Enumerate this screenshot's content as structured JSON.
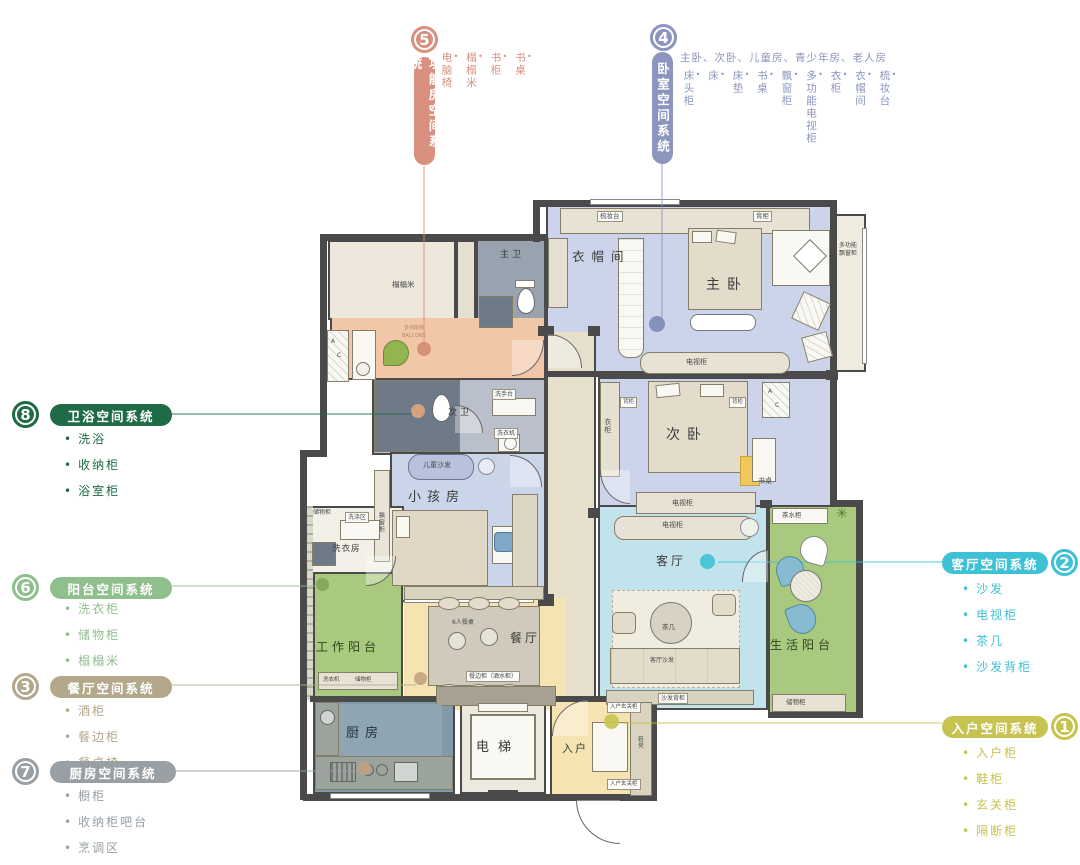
{
  "systems": {
    "s1": {
      "num": "1",
      "name": "入户空间系统",
      "color": "#C6C350",
      "items": [
        "入户柜",
        "鞋柜",
        "玄关柜",
        "隔断柜"
      ]
    },
    "s2": {
      "num": "2",
      "name": "客厅空间系统",
      "color": "#3EC1D5",
      "items": [
        "沙发",
        "电视柜",
        "茶几",
        "沙发背柜"
      ]
    },
    "s3": {
      "num": "3",
      "name": "餐厅空间系统",
      "color": "#B4A88C",
      "items": [
        "酒柜",
        "餐边柜",
        "餐桌椅"
      ]
    },
    "s4": {
      "num": "4",
      "name": "卧室空间系统",
      "color": "#8C95BE",
      "note": "主卧、次卧、儿童房、青少年房、老人房",
      "items": [
        "床头柜",
        "床",
        "床垫",
        "书桌",
        "飘窗柜",
        "多功能电视柜",
        "衣柜",
        "衣帽间",
        "梳妆台"
      ]
    },
    "s5": {
      "num": "5",
      "name": "功能房空间系统",
      "color": "#D9907E",
      "items": [
        "电脑椅",
        "榻榻米",
        "书柜",
        "书桌"
      ]
    },
    "s6": {
      "num": "6",
      "name": "阳台空间系统",
      "color": "#8FBF8C",
      "items": [
        "洗衣柜",
        "储物柜",
        "榻榻米",
        "茶水柜"
      ]
    },
    "s7": {
      "num": "7",
      "name": "厨房空间系统",
      "color": "#98A0A5",
      "items": [
        "橱柜",
        "收纳柜吧台",
        "烹调区"
      ]
    },
    "s8": {
      "num": "8",
      "name": "卫浴空间系统",
      "color": "#1E6B45",
      "items": [
        "洗浴",
        "收纳柜",
        "浴室柜"
      ]
    }
  },
  "floorplan": {
    "rooms": {
      "tatami": "榻榻米",
      "master_bath": "主卫",
      "second_bath": "次卫",
      "cloakroom": "衣帽间",
      "master_bedroom": "主卧",
      "second_bedroom": "次卧",
      "kids_room": "小孩房",
      "laundry": "洗衣房",
      "work_balcony": "工作阳台",
      "dining": "餐厅",
      "living": "客厅",
      "life_balcony": "生活阳台",
      "kitchen": "厨房",
      "elevator": "电梯",
      "entry": "入户"
    },
    "furniture": [
      {
        "t": "梳妆台",
        "x": 597,
        "y": 211,
        "chip": 1
      },
      {
        "t": "背柜",
        "x": 753,
        "y": 211,
        "chip": 1
      },
      {
        "t": "多功能飘窗柜",
        "x": 839,
        "y": 242,
        "fs": 6,
        "w": 20
      },
      {
        "t": "电视柜",
        "x": 686,
        "y": 358,
        "fs": 7
      },
      {
        "t": "背柜",
        "x": 620,
        "y": 397,
        "chip": 1,
        "fs": 5.5
      },
      {
        "t": "背柜",
        "x": 729,
        "y": 397,
        "chip": 1,
        "fs": 5.5
      },
      {
        "t": "衣柜",
        "x": 603,
        "y": 418,
        "v": 1,
        "fs": 7
      },
      {
        "t": "书桌",
        "x": 758,
        "y": 477,
        "fs": 7
      },
      {
        "t": "电视柜",
        "x": 672,
        "y": 499,
        "fs": 7
      },
      {
        "t": "电视柜",
        "x": 662,
        "y": 521,
        "fs": 7
      },
      {
        "t": "茶几",
        "x": 662,
        "y": 623,
        "fs": 6.5
      },
      {
        "t": "客厅沙发",
        "x": 650,
        "y": 657,
        "fs": 6
      },
      {
        "t": "沙发背柜",
        "x": 658,
        "y": 693,
        "chip": 1,
        "fs": 6
      },
      {
        "t": "儿童沙发",
        "x": 423,
        "y": 461,
        "fs": 7
      },
      {
        "t": "飘窗柜",
        "x": 377,
        "y": 512,
        "v": 1,
        "fs": 6
      },
      {
        "t": "洗手台",
        "x": 492,
        "y": 389,
        "chip": 1,
        "fs": 6
      },
      {
        "t": "洗衣机",
        "x": 494,
        "y": 428,
        "chip": 1,
        "fs": 6
      },
      {
        "t": "储物柜",
        "x": 313,
        "y": 509,
        "fs": 6
      },
      {
        "t": "洗涤区",
        "x": 345,
        "y": 512,
        "chip": 1,
        "fs": 6
      },
      {
        "t": "茶水柜",
        "x": 782,
        "y": 511,
        "fs": 6.5
      },
      {
        "t": "6人餐桌",
        "x": 452,
        "y": 619,
        "fs": 6
      },
      {
        "t": "餐边柜（酒水柜）",
        "x": 466,
        "y": 671,
        "chip": 1,
        "fs": 6
      },
      {
        "t": "洗衣机",
        "x": 323,
        "y": 677,
        "fs": 5.5
      },
      {
        "t": "储物柜",
        "x": 355,
        "y": 677,
        "fs": 5.5
      },
      {
        "t": "储物柜",
        "x": 786,
        "y": 698,
        "fs": 6.5
      },
      {
        "t": "入户玄关柜",
        "x": 607,
        "y": 702,
        "chip": 1,
        "fs": 5.5
      },
      {
        "t": "入户玄关柜",
        "x": 607,
        "y": 779,
        "chip": 1,
        "fs": 5.5
      },
      {
        "t": "鞋凳",
        "x": 636,
        "y": 736,
        "v": 1,
        "fs": 5.5
      },
      {
        "t": "榻榻米",
        "x": 392,
        "y": 280,
        "fs": 7.5
      },
      {
        "t": "多功能房",
        "x": 404,
        "y": 325,
        "fs": 5,
        "color": "#B08968"
      },
      {
        "t": "BALCONY",
        "x": 402,
        "y": 333,
        "fs": 5,
        "color": "#B08968"
      },
      {
        "t": "A",
        "x": 331,
        "y": 338,
        "fs": 6
      },
      {
        "t": "C",
        "x": 337,
        "y": 352,
        "fs": 6
      },
      {
        "t": "A",
        "x": 768,
        "y": 388,
        "fs": 6
      },
      {
        "t": "C",
        "x": 775,
        "y": 402,
        "fs": 6
      }
    ]
  }
}
